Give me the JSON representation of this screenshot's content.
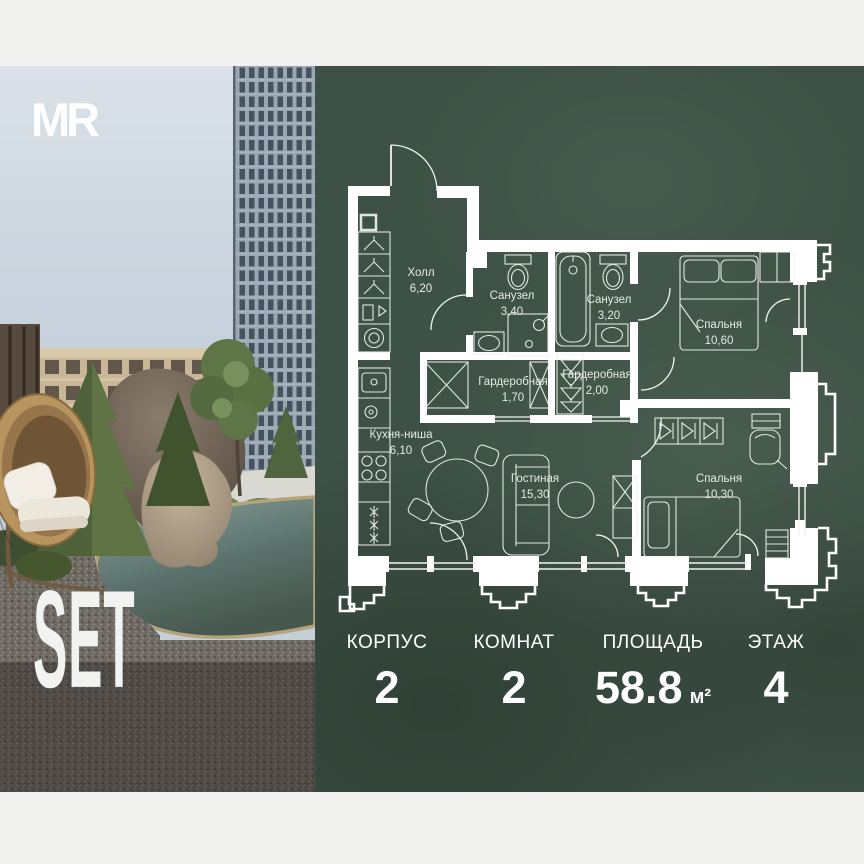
{
  "brand": {
    "logo_text": "MR",
    "project_name": "SET"
  },
  "floor_plan": {
    "rooms": [
      {
        "name": "Холл",
        "area": "6,20"
      },
      {
        "name": "Санузел",
        "area": "3,40"
      },
      {
        "name": "Санузел",
        "area": "3,20"
      },
      {
        "name": "Спальня",
        "area": "10,60"
      },
      {
        "name": "Гардеробная",
        "area": "1,70"
      },
      {
        "name": "Гардеробная",
        "area": "2,00"
      },
      {
        "name": "Кухня-ниша",
        "area": "6,10"
      },
      {
        "name": "Гостиная",
        "area": "15,30"
      },
      {
        "name": "Спальня",
        "area": "10,30"
      }
    ]
  },
  "stats": {
    "items": [
      {
        "label": "КОРПУС",
        "value": "2",
        "unit": ""
      },
      {
        "label": "КОМНАТ",
        "value": "2",
        "unit": ""
      },
      {
        "label": "ПЛОЩАДЬ",
        "value": "58.8",
        "unit": "м²"
      },
      {
        "label": "ЭТАЖ",
        "value": "4",
        "unit": ""
      }
    ]
  },
  "colors": {
    "panel_green": "#3e5146",
    "wall_white": "#ffffff"
  }
}
